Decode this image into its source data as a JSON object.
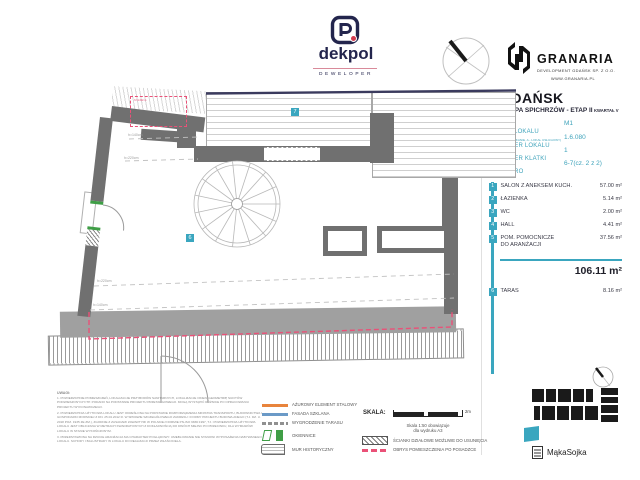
{
  "branding": {
    "dekpol_name": "dekpol",
    "dekpol_tagline": "DEWELOPER",
    "granaria_name": "GRANARIA",
    "granaria_sub1": "DEVELOPMENT GDAŃSK SP. Z O.O.",
    "granaria_sub2": "WWW.GRANARIA.PL",
    "architect_name": "MąkaSojka"
  },
  "panel": {
    "city": "GDAŃSK",
    "project": "WYSPA SPICHRZÓW - ETAP II",
    "quarter": "KWARTAŁ V",
    "fields": [
      {
        "label": "TYP LOKALU",
        "sub": "(M - MIESZKANIE, A - LOKAL USŁUGOWY)",
        "value": "M1"
      },
      {
        "label": "NUMER LOKALU",
        "value": "1.6.080"
      },
      {
        "label": "NUMER KLATKI",
        "value": "1"
      },
      {
        "label": "PIĘTRO",
        "value": "6-7(cz. 2 z 2)"
      }
    ],
    "rooms": [
      {
        "no": "1",
        "name": "SALON Z ANEKSEM KUCH.",
        "area": "57.00 m²"
      },
      {
        "no": "2",
        "name": "ŁAZIENKA",
        "area": "5.14 m²"
      },
      {
        "no": "3",
        "name": "WC",
        "area": "2.00 m²"
      },
      {
        "no": "4",
        "name": "HALL",
        "area": "4.41 m²"
      },
      {
        "no": "5",
        "name": "POM. POMOCNICZE",
        "name_line2": "DO ARANŻACJI",
        "area": "37.56 m²"
      }
    ],
    "total_area": "106.11 m²",
    "terrace": {
      "no": "6",
      "name": "TARAS",
      "area": "8.16 m²"
    }
  },
  "plan": {
    "badge_terrace": "7",
    "badge_room": "6",
    "dim_top1": "h=140cm",
    "dim_top2": "h=220cm",
    "dim_mid1": "h=220cm",
    "dim_mid2": "h=140cm",
    "dim_pink": "h=140cm"
  },
  "legend": {
    "items": [
      {
        "label": "AŻUROWY ELEMENT STALOWY"
      },
      {
        "label": "FASADA SZKLANA"
      },
      {
        "label": "WYGRODZENIE TARASU"
      },
      {
        "label": "OKIENNICE"
      },
      {
        "label": "MUR HISTORYCZNY"
      },
      {
        "label": "ŚCIANKI DZIAŁOWE MOŻLIWE DO USUNIĘCIA"
      },
      {
        "label": "OBRYS POMIESZCZENIA PO POSADZCE"
      }
    ]
  },
  "scale": {
    "label": "SKALA:",
    "mark": "2m",
    "note_line1": "Skala 1:50 obowiązuje",
    "note_line2": "dla wydruku A3"
  },
  "notes": {
    "title": "UWAGI:",
    "items": [
      "1. POWIERZCHNIE POMIESZCZEŃ, LOKALIZACJE PRZYBORÓW SANITARNYCH, LOKALIZACJE OKIEN, GEOMETRIĘ SUFITÓW PODWIESZONYCH ITP. PODANO NA PODSTAWIE PROJEKTU PRZETARGOWEGO. MOGĄ WYSTĄPIĆ RÓŻNICE PO OPRACOWANIU PROJEKTU WYKONAWCZEGO.",
      "2. POWIERZCHNIA UŻYTKOWA LOKALU JEST OKREŚLONA NA PODSTAWIE ROZPORZĄDZENIA MINISTRA TRANSPORTU, BUDOWNICTWA I GOSPODARKI MORSKIEJ Z DN. 25.04.2012 R. W SPRAWIE SZCZEGÓŁOWEGO ZAKRESU I FORMY PROJEKTU BUDOWLANEGO (T.J. DZ. U. 2018 POZ. 1935 ZE ZM.), ZGODNIE Z ZASADAMI ZAWARTYMI W POLSKIEJ NORMIE PN-ISO 9836:1997, TJ.: POWIERZCHNIA UŻYTKOWA LOKALU JEST OBLICZANA W METRACH KWADRATOWYCH Z DOKŁADNOŚCIĄ DO DWÓCH MIEJSC PO PRZECINKU, DLA WYMIARÓW LOKALU W STANIE WYKOŃCZONYM.",
      "3. PRZEDSTAWIONA NA RZUCIE ARANŻACJA MA CHARAKTER POGLĄDOWY. UMEBLOWANIE NIE STANOWI WYPOSAŻENIA NABYWANEGO LOKALU. SCHODY I BALUSTRADY W LOKALU DO REALIZACJI PRZEZ WŁAŚCICIELA."
    ]
  },
  "colors": {
    "accent": "#3aa6bf",
    "wall": "#707070",
    "pink": "#ea5178",
    "navy": "#23254d",
    "orange": "#e8843c",
    "blue": "#6b9ac7",
    "green": "#3f9e46"
  }
}
